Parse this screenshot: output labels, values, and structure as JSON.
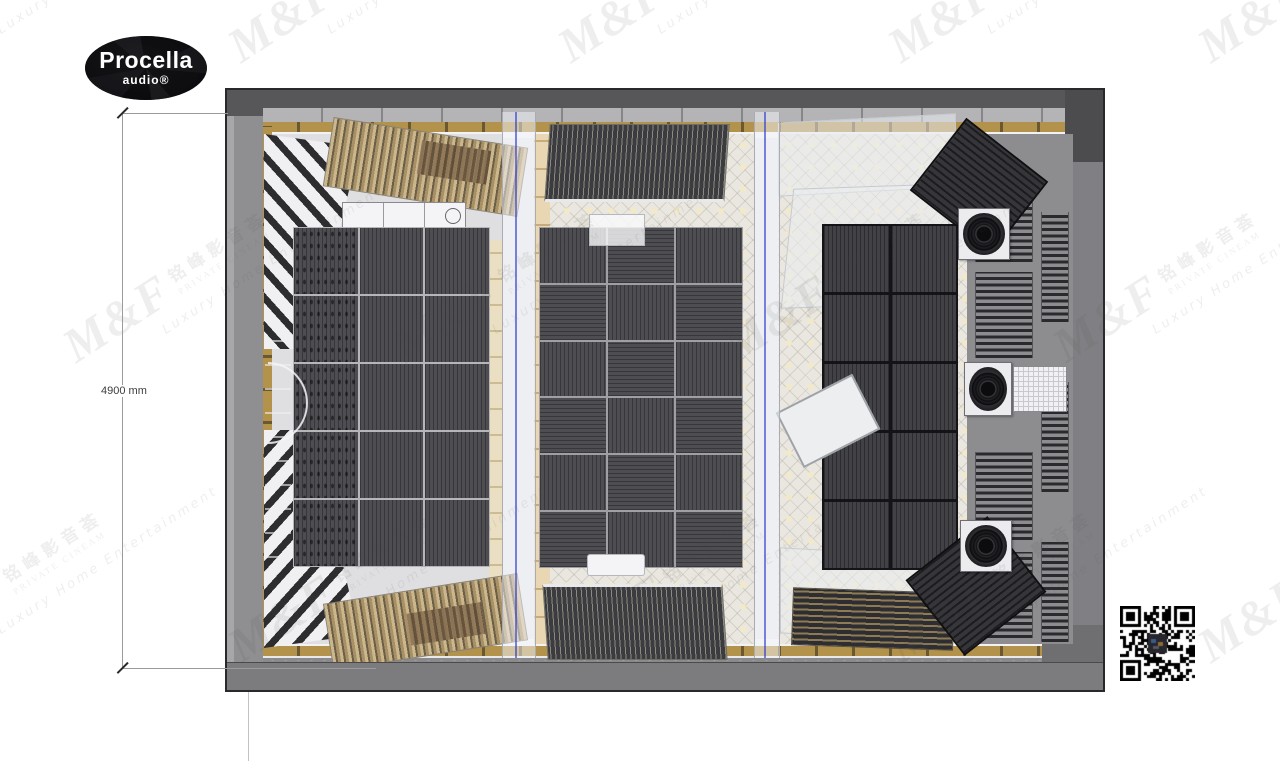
{
  "logo": {
    "brand": "Procella",
    "sub": "audio®"
  },
  "dimension": {
    "label": "4900 mm"
  },
  "watermark": {
    "brand": "M&F",
    "chinese": "铭峰影音荟",
    "line1": "PRIVATE CINEAM",
    "line2": "Luxury Home Entertainment"
  },
  "room": {
    "type": "home-theater-top-view-render",
    "panels": {
      "left_grid": {
        "cols": 3,
        "rows": 5
      },
      "middle_grid": {
        "cols": 3,
        "rows": 6
      },
      "right_grid": {
        "cols": 2,
        "rows": 5
      }
    },
    "speaker_count_right_wall": 3
  },
  "colors": {
    "wall_dark": "#57575a",
    "wall_mid": "#8a8a8d",
    "panel_dark": "#46464a",
    "gold_trim": "#b3924c",
    "wallpaper": "#eae7e0",
    "glass_accent_blue": "#2636c9",
    "logo_bg": "#0e0e10"
  }
}
